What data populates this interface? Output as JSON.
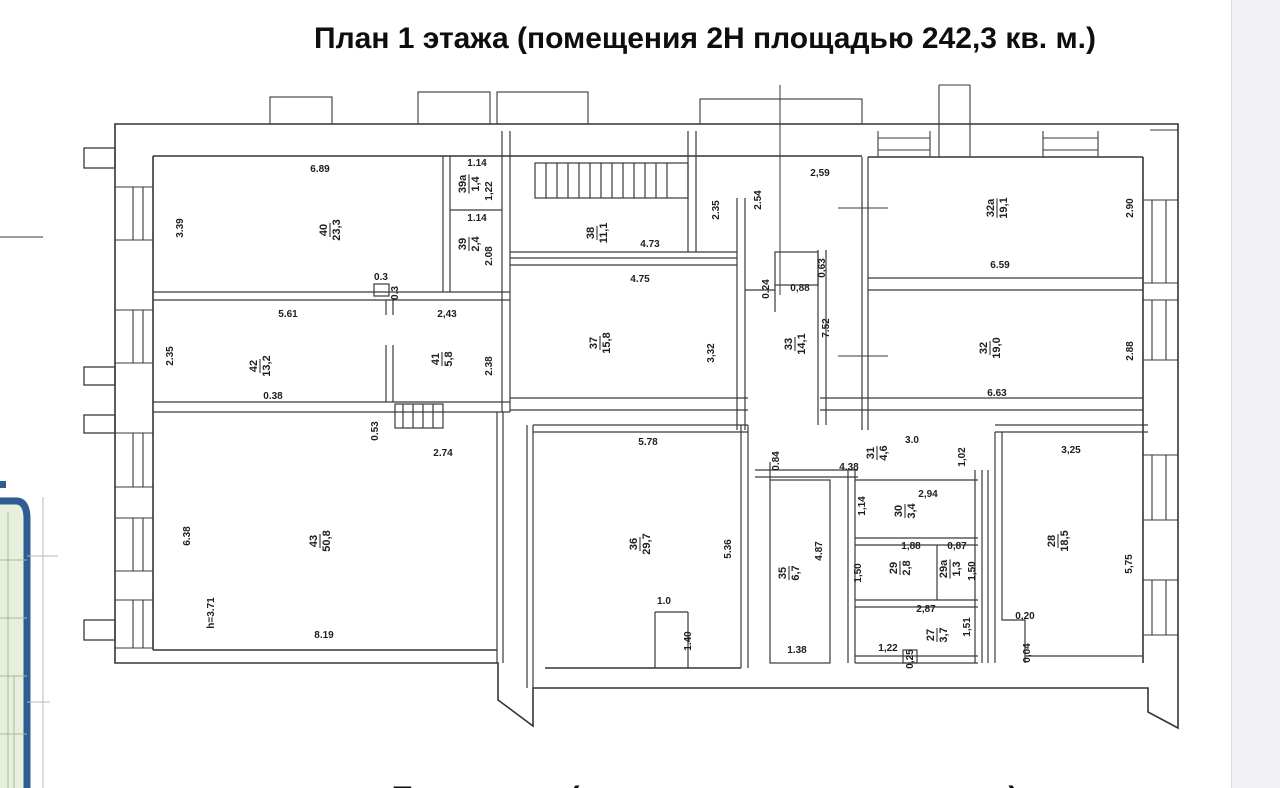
{
  "title": "План 1 этажа (помещения 2Н площадью 242,3 кв. м.)",
  "bottom_caption_partial": "План этажа (помещения площадью кв. м.)",
  "colors": {
    "ink": "#2f2f2f",
    "fragment_border": "#2e5d94",
    "fragment_fill": "#e7efdd",
    "page_edge": "#f1f1f4"
  },
  "plan": {
    "rooms": [
      {
        "number": "40",
        "area": "23,3",
        "x": 330,
        "y": 230
      },
      {
        "number": "39а",
        "area": "1,4",
        "x": 469,
        "y": 184
      },
      {
        "number": "39",
        "area": "2,4",
        "x": 469,
        "y": 244
      },
      {
        "number": "38",
        "area": "11,1",
        "x": 597,
        "y": 233
      },
      {
        "number": "37",
        "area": "15,8",
        "x": 600,
        "y": 343
      },
      {
        "number": "33",
        "area": "14,1",
        "x": 795,
        "y": 344
      },
      {
        "number": "32а",
        "area": "19,1",
        "x": 997,
        "y": 208
      },
      {
        "number": "32",
        "area": "19,0",
        "x": 990,
        "y": 348
      },
      {
        "number": "42",
        "area": "13,2",
        "x": 260,
        "y": 366
      },
      {
        "number": "41",
        "area": "5,8",
        "x": 442,
        "y": 359
      },
      {
        "number": "43",
        "area": "50,8",
        "x": 320,
        "y": 541
      },
      {
        "number": "36",
        "area": "29,7",
        "x": 640,
        "y": 544
      },
      {
        "number": "35",
        "area": "6,7",
        "x": 789,
        "y": 573
      },
      {
        "number": "31",
        "area": "4,6",
        "x": 877,
        "y": 453
      },
      {
        "number": "30",
        "area": "3,4",
        "x": 905,
        "y": 511
      },
      {
        "number": "29",
        "area": "2,8",
        "x": 900,
        "y": 568
      },
      {
        "number": "29а",
        "area": "1,3",
        "x": 950,
        "y": 569
      },
      {
        "number": "27",
        "area": "3,7",
        "x": 937,
        "y": 635
      },
      {
        "number": "28",
        "area": "18,5",
        "x": 1058,
        "y": 541
      }
    ],
    "dimensions": [
      {
        "text": "6.89",
        "x": 320,
        "y": 172
      },
      {
        "text": "3.39",
        "x": 183,
        "y": 228,
        "rot": -90
      },
      {
        "text": "0.3",
        "x": 381,
        "y": 280
      },
      {
        "text": "0.3",
        "x": 398,
        "y": 293,
        "rot": -90
      },
      {
        "text": "1.14",
        "x": 477,
        "y": 166
      },
      {
        "text": "1,22",
        "x": 492,
        "y": 191,
        "rot": -90
      },
      {
        "text": "1.14",
        "x": 477,
        "y": 221
      },
      {
        "text": "2.08",
        "x": 492,
        "y": 256,
        "rot": -90
      },
      {
        "text": "4.73",
        "x": 650,
        "y": 247
      },
      {
        "text": "4.75",
        "x": 640,
        "y": 282
      },
      {
        "text": "2.35",
        "x": 719,
        "y": 210,
        "rot": -90
      },
      {
        "text": "2.54",
        "x": 761,
        "y": 200,
        "rot": -90
      },
      {
        "text": "2,59",
        "x": 820,
        "y": 176
      },
      {
        "text": "0,63",
        "x": 825,
        "y": 268,
        "rot": -90
      },
      {
        "text": "0,88",
        "x": 800,
        "y": 291
      },
      {
        "text": "0.24",
        "x": 769,
        "y": 289,
        "rot": -90
      },
      {
        "text": "2.90",
        "x": 1133,
        "y": 208,
        "rot": -90
      },
      {
        "text": "6.59",
        "x": 1000,
        "y": 268
      },
      {
        "text": "7.52",
        "x": 829,
        "y": 328,
        "rot": -90
      },
      {
        "text": "3,32",
        "x": 714,
        "y": 353,
        "rot": -90
      },
      {
        "text": "2.88",
        "x": 1133,
        "y": 351,
        "rot": -90
      },
      {
        "text": "6.63",
        "x": 997,
        "y": 396
      },
      {
        "text": "5.61",
        "x": 288,
        "y": 317
      },
      {
        "text": "2.35",
        "x": 173,
        "y": 356,
        "rot": -90
      },
      {
        "text": "0.38",
        "x": 273,
        "y": 399
      },
      {
        "text": "2,43",
        "x": 447,
        "y": 317
      },
      {
        "text": "2.38",
        "x": 492,
        "y": 366,
        "rot": -90
      },
      {
        "text": "0.53",
        "x": 378,
        "y": 431,
        "rot": -90
      },
      {
        "text": "2.74",
        "x": 443,
        "y": 456
      },
      {
        "text": "6.38",
        "x": 190,
        "y": 536,
        "rot": -90
      },
      {
        "text": "h=3.71",
        "x": 214,
        "y": 613,
        "rot": -90
      },
      {
        "text": "8.19",
        "x": 324,
        "y": 638
      },
      {
        "text": "5.78",
        "x": 648,
        "y": 445
      },
      {
        "text": "5.36",
        "x": 731,
        "y": 549,
        "rot": -90
      },
      {
        "text": "1.0",
        "x": 664,
        "y": 604
      },
      {
        "text": "1.40",
        "x": 691,
        "y": 641,
        "rot": -90
      },
      {
        "text": "0.84",
        "x": 779,
        "y": 461,
        "rot": -90
      },
      {
        "text": "4.87",
        "x": 822,
        "y": 551,
        "rot": -90
      },
      {
        "text": "1.38",
        "x": 797,
        "y": 653
      },
      {
        "text": "3.0",
        "x": 912,
        "y": 443
      },
      {
        "text": "4.38",
        "x": 849,
        "y": 470
      },
      {
        "text": "1,02",
        "x": 965,
        "y": 457,
        "rot": -90
      },
      {
        "text": "2,94",
        "x": 928,
        "y": 497
      },
      {
        "text": "1,14",
        "x": 865,
        "y": 506,
        "rot": -90
      },
      {
        "text": "1,88",
        "x": 911,
        "y": 549
      },
      {
        "text": "1,50",
        "x": 861,
        "y": 573,
        "rot": -90
      },
      {
        "text": "0,87",
        "x": 957,
        "y": 549
      },
      {
        "text": "1,50",
        "x": 975,
        "y": 571,
        "rot": -90
      },
      {
        "text": "2,87",
        "x": 926,
        "y": 612
      },
      {
        "text": "1,51",
        "x": 970,
        "y": 627,
        "rot": -90
      },
      {
        "text": "1,22",
        "x": 888,
        "y": 651
      },
      {
        "text": "0,25",
        "x": 913,
        "y": 659,
        "rot": -90
      },
      {
        "text": "3,25",
        "x": 1071,
        "y": 453
      },
      {
        "text": "5,75",
        "x": 1132,
        "y": 564,
        "rot": -90
      },
      {
        "text": "0,20",
        "x": 1025,
        "y": 619
      },
      {
        "text": "0,04",
        "x": 1030,
        "y": 653,
        "rot": -90
      }
    ]
  }
}
